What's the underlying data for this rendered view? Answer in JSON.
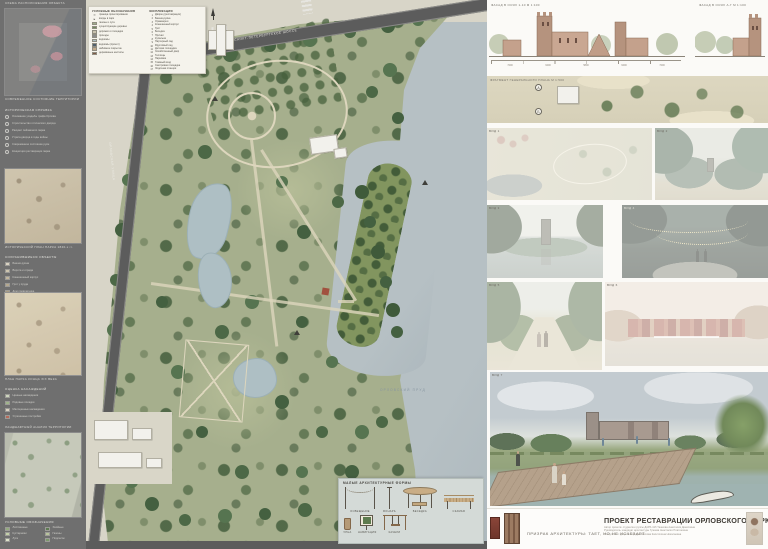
{
  "sidebar": {
    "top_caption": "СХЕМА РАСПОЛОЖЕНИЯ ОБЪЕКТА",
    "thumb1_caption": "СОВРЕМЕННОЕ СОСТОЯНИЕ ТЕРРИТОРИИ",
    "history_title": "ИСТОРИЧЕСКАЯ СПРАВКА",
    "history_items": [
      "Основание усадьбы графа Орлова",
      "Строительство готического дворца",
      "Расцвет пейзажного парка",
      "Утрата дворца в годы войны",
      "Современное состояние руин",
      "Концепция реставрации парка"
    ],
    "thumb2_caption": "ИСТОРИЧЕСКИЙ ПЛАН ПАРКА 1840-х гг.",
    "list2_title": "СОХРАНИВШИЕСЯ ОБЪЕКТЫ",
    "list2": [
      {
        "c": "#d9d2c2",
        "t": "Башня-руина"
      },
      {
        "c": "#cdc4ae",
        "t": "Ворота и ограда"
      },
      {
        "c": "#c2b69d",
        "t": "Конюшенный корпус"
      },
      {
        "c": "#b5a88e",
        "t": "Грот у пруда"
      },
      {
        "c": "#a99c82",
        "t": "Дом привратника"
      }
    ],
    "thumb3_caption": "ПЛАН ПАРКА КОНЦА XIX ВЕКА",
    "list3_title": "ОЦЕНКА НАСАЖДЕНИЙ",
    "list3": [
      {
        "c": "#cdd6bd",
        "t": "Ценные насаждения"
      },
      {
        "c": "#9fb58a",
        "t": "Рядовые посадки"
      },
      {
        "c": "#d9d2c2",
        "t": "Малоценные насаждения"
      },
      {
        "c": "#b56a5a",
        "t": "Утраченные постройки"
      }
    ],
    "thumb4_caption": "ЛАНДШАФТНЫЙ АНАЛИЗ ТЕРРИТОРИИ",
    "legend_title": "УСЛОВНЫЕ ОБОЗНАЧЕНИЯ",
    "legend": [
      {
        "c": "#94ab7f",
        "t": "Лиственные"
      },
      {
        "c": "#5e7b52",
        "t": "Хвойные"
      },
      {
        "c": "#c3d0a8",
        "t": "Кустарники"
      },
      {
        "c": "#b8c49b",
        "t": "Газоны"
      },
      {
        "c": "#dce3c9",
        "t": "Луга"
      },
      {
        "c": "#7b9a6b",
        "t": "Подлесок"
      }
    ]
  },
  "map": {
    "legend": {
      "title": "УСЛОВНЫЕ ОБОЗНАЧЕНИЯ",
      "symbols": [
        {
          "s": "━",
          "t": "граница проектирования"
        },
        {
          "s": "▸",
          "t": "входы в парк"
        }
      ],
      "swatches": [
        {
          "c": "#9fae8c",
          "t": "газоны и луга"
        },
        {
          "c": "#6f8a5e",
          "t": "существующие деревья"
        },
        {
          "c": "#c9c2ae",
          "t": "дорожки и площадки"
        },
        {
          "c": "#8c8c8c",
          "t": "проезды"
        },
        {
          "c": "#aebfc4",
          "t": "водоёмы"
        },
        {
          "c": "#51606e",
          "t": "водоёмы (проект)"
        },
        {
          "c": "#c2a98b",
          "t": "набивное покрытие"
        },
        {
          "c": "#7d5b47",
          "t": "деревянные настилы"
        }
      ],
      "explication_title": "ЭКСПЛИКАЦИЯ",
      "explication": [
        "Дворец (реставрация)",
        "Башня-руина",
        "Оранжерея",
        "Конюшенный корпус",
        "Грот",
        "Беседка",
        "Причал",
        "Купальня",
        "Партерный сад",
        "Фруктовый сад",
        "Детская площадка",
        "Хозяйственный двор",
        "Теплицы",
        "Парковка",
        "Главный вход",
        "Смотровая площадка",
        "Лодочная станция"
      ]
    },
    "street_top": "САНКТ-ПЕТЕРБУРГСКОЕ ШОССЕ",
    "street_left": "ОРЛОВСКАЯ УЛИЦА",
    "pond_label": "ОРЛОВСКИЙ ПРУД",
    "maf": {
      "title": "МАЛЫЕ АРХИТЕКТУРНЫЕ ФОРМЫ",
      "items": [
        {
          "label": "ОСВЕЩЕНИЕ"
        },
        {
          "label": "ФОНАРЬ"
        },
        {
          "label": "БЕСЕДКА"
        },
        {
          "label": "СКАМЬЯ"
        },
        {
          "label": "УРНА"
        },
        {
          "label": "НАВИГАЦИЯ"
        },
        {
          "label": "КАЧЕЛИ"
        }
      ]
    }
  },
  "right": {
    "facade_label_left": "ФАСАД В ОСЯХ 1-10  М 1:100",
    "facade_label_right": "ФАСАД В ОСЯХ А-Г  М 1:100",
    "facade_dims": [
      "7200",
      "6400",
      "5800",
      "6400",
      "7200"
    ],
    "siteplan_label": "ФРАГМЕНТ ГЕНЕРАЛЬНОГО ПЛАНА  М 1:500",
    "siteplan_axes": [
      "А",
      "Б"
    ],
    "views": {
      "aerial": "ВИД 1",
      "vista": "ВИД 2",
      "pond": "ВИД 3",
      "night": "ВИД 4",
      "alley": "ВИД 5",
      "palace": "ВИД 6",
      "render": "ВИД 7"
    },
    "title_block": {
      "slogan": "ПРИЗРАК АРХИТЕКТУРЫ: ТАЕТ, НО НЕ ИСЧЕЗАЕТ",
      "title": "ПРОЕКТ РЕСТАВРАЦИИ ОРЛОВСКОГО ПАРКА",
      "credits": [
        "Автор проекта: студентка группы ДАРХ-41б Ташкова Анастасия Денисовна",
        "Руководитель: кандидат архитектуры Гузеева Анастасия Платоновна",
        "Консультант: доцент кафедры Мягкова Капитолина Николаевна"
      ]
    }
  }
}
